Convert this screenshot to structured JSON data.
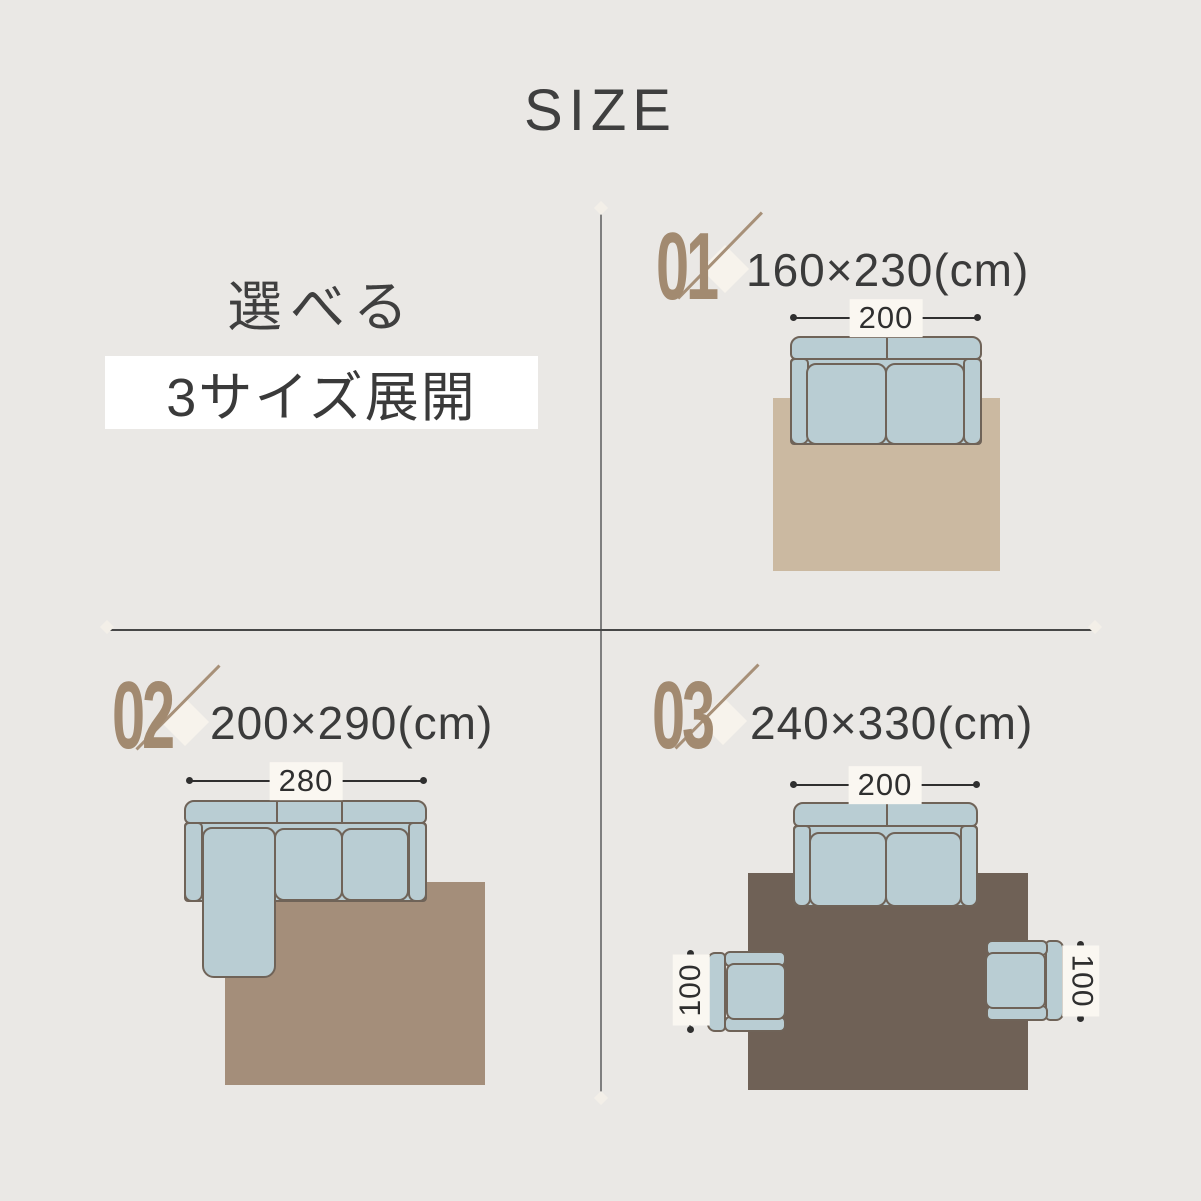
{
  "title": "SIZE",
  "intro": {
    "heading": "選べる",
    "highlight": "3サイズ展開"
  },
  "items": [
    {
      "number": "01",
      "size": "160×230(cm)",
      "sofa_width": "200"
    },
    {
      "number": "02",
      "size": "200×290(cm)",
      "sofa_width": "280"
    },
    {
      "number": "03",
      "size": "240×330(cm)",
      "sofa_width": "200",
      "chair_left": "100",
      "chair_right": "100"
    }
  ],
  "colors": {
    "background": "#eae8e5",
    "rug_small": "#cbb9a1",
    "rug_medium": "#a48e7a",
    "rug_large": "#6f6156",
    "sofa_fill": "#b9cdd3",
    "sofa_outline": "#6f6358",
    "number_accent": "#a28a70",
    "text": "#3b3b3b",
    "highlight_box": "#ffffff"
  }
}
